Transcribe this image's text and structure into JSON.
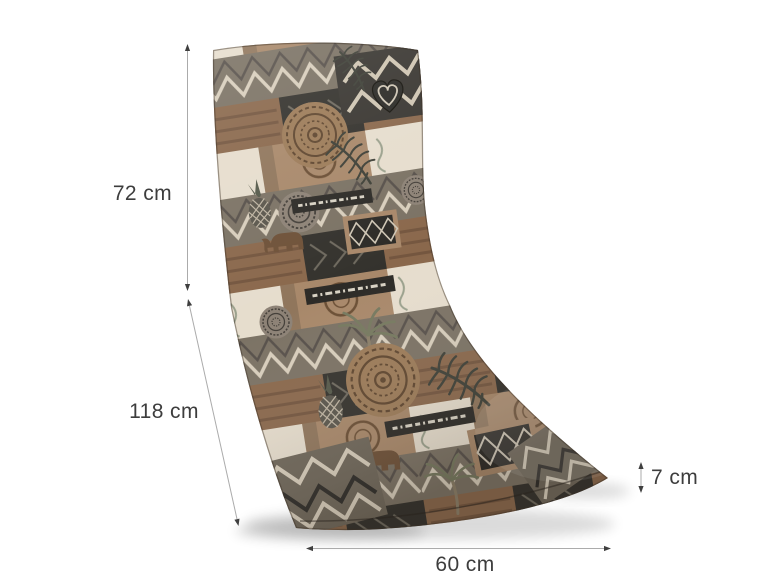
{
  "figure": {
    "name": "lounger-cushion-dimension-diagram",
    "product": "Patchwork garden lounger cushion shown with dimension arrows",
    "background": "#ffffff",
    "dimension_labels": {
      "backrest": "72 cm",
      "seat": "118 cm",
      "thickness": "7 cm",
      "width": "60 cm"
    },
    "colors": {
      "dimension_line": "#ababab",
      "dimension_arrow": "#3f3f3f",
      "label_text": "#3d3d3d",
      "cushion_palette": [
        "#e6ddcd",
        "#bfb0a0",
        "#a8886a",
        "#8a684c",
        "#7b7264",
        "#55594a",
        "#34322d",
        "#2b2a26"
      ]
    }
  }
}
